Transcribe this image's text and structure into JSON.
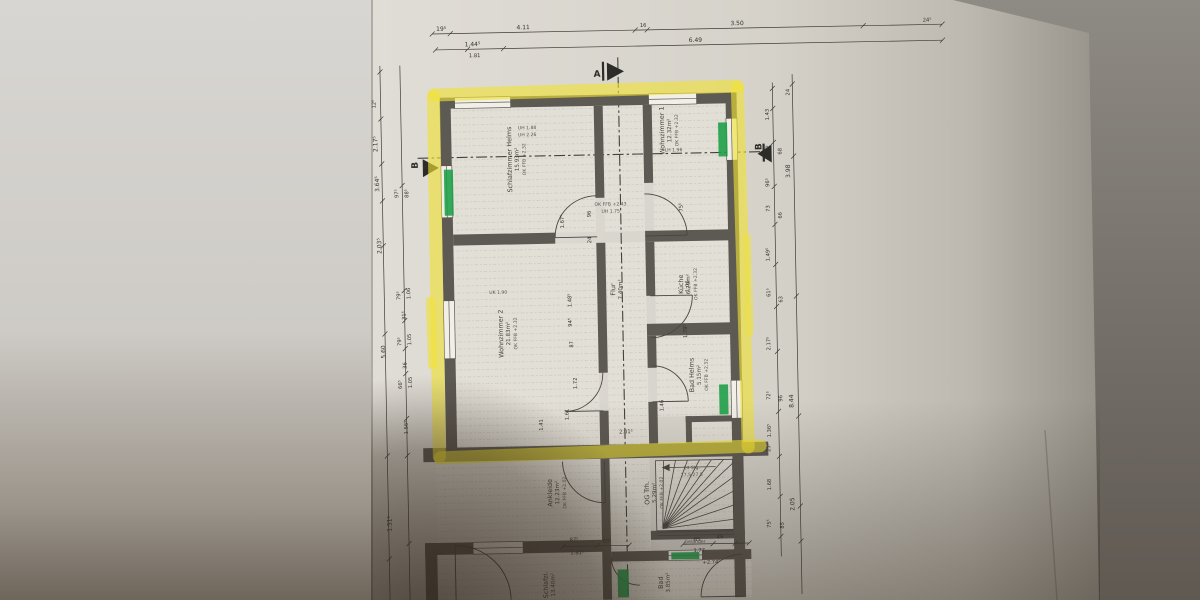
{
  "section_markers": {
    "a": "A",
    "b_left": "B",
    "b_right": "B"
  },
  "rooms": {
    "schlafzimmer1": {
      "name": "Schlafzimmer Helms",
      "area": "15.93m²",
      "level": "OK FFB +2.32"
    },
    "wohnzimmer1": {
      "name": "Wohnzimmer 1",
      "area": "12.32m²",
      "level": "OK FFB +2.32"
    },
    "kueche": {
      "name": "Küche",
      "area": "6.29m²",
      "level": "OK FFB +2.32"
    },
    "flur": {
      "name": "Flur",
      "area": "7.40m²"
    },
    "wohnzimmer2": {
      "name": "Wohnzimmer 2",
      "area": "21.83m²",
      "level": "OK FFB +2.32"
    },
    "bad1": {
      "name": "Bad Helms",
      "area": "5.15m²",
      "level": "OK FFB +2.32"
    },
    "ankleide": {
      "name": "Ankleide",
      "area": "12.23m²",
      "level": "OK FFB +2.02"
    },
    "og_trh": {
      "name": "OG Trh.",
      "area": "5.29m²",
      "level": "OK FFB +2.02"
    },
    "schlafzi2": {
      "name": "Schlafzi.",
      "area": "13.40m²"
    },
    "bad2": {
      "name": "Bad",
      "area": "3.85m²"
    }
  },
  "stairs": {
    "steps": "14 Stg.",
    "tread": "17,5/27,5",
    "railing": "Geländer"
  },
  "annotations": {
    "a1": "UH 1.88",
    "a2": "UH 2.26",
    "a3": "UK 1.90",
    "a4": "LH 1.96",
    "a5": "OK FFB +2.43",
    "a6": "UH 1.75"
  },
  "dims": {
    "top1": [
      "19⁵",
      "4.11",
      "16",
      "3.50",
      "24⁵"
    ],
    "top2": [
      "1.44⁵",
      "1.81",
      "6.49"
    ],
    "left_outer": [
      "12⁵",
      "2.17⁵",
      "3.64⁵",
      "2.03⁵",
      "5.60",
      "1.51⁵"
    ],
    "left_inner": [
      "97⁵",
      "88⁵",
      "79⁵",
      "1.06",
      "31⁵",
      "79⁵",
      "1.05",
      "36",
      "66⁵",
      "1.05",
      "1.56⁵"
    ],
    "right_inner": [
      "1.43",
      "72",
      "96⁵",
      "73",
      "1.49⁵",
      "61⁵",
      "2.17⁵",
      "72⁵",
      "1.36⁵",
      "25⁵",
      "1.68",
      "75⁵"
    ],
    "right_mid": [
      "68",
      "66",
      "63",
      "96",
      "85"
    ],
    "right_outer": [
      "24",
      "3.98",
      "8.44",
      "2.05"
    ],
    "interior": [
      "1.67⁵",
      "96",
      "24",
      "75⁵",
      "1.48⁵",
      "87",
      "1.72",
      "1.61",
      "1.46",
      "2.01⁵",
      "1.41",
      "1.06",
      "1.79⁵",
      "94⁵"
    ],
    "bottom": [
      "87⁵",
      "65⁵",
      "1.81⁵",
      "85",
      "49",
      "1.77",
      "+2.74⁵"
    ]
  },
  "colors": {
    "highlighter": "#f0e234",
    "marker_green": "#1a9e46",
    "wall": "#5d5953",
    "paper": "#d9d6ce"
  }
}
